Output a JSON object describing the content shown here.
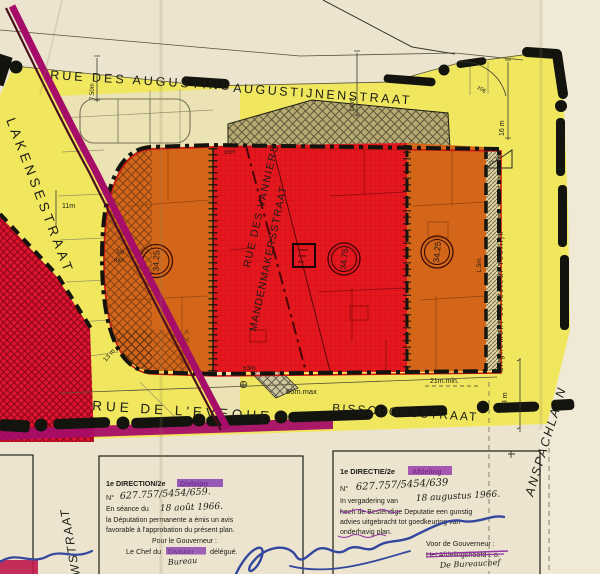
{
  "map": {
    "streets": {
      "rue_des_augustins": "RUE DES AUGUSTINS",
      "augustijnenstraat": "AUGUSTIJNENSTRAAT",
      "lakensestraat": "LAKENSESTRAAT",
      "rue_des_vanniers": "RUE DES VANNIERS",
      "mandenmakersstraat": "MANDENMAKERSSTRAAT",
      "rue_de_l_eveque": "RUE  DE  L'EVEQUE",
      "bisschopsstraat": "BISSCHOPSSTRAAT",
      "anspachlaan": "ANSPACHLAAN",
      "wstraat_partial": "WSTRAAT"
    },
    "measurements": {
      "m750": "7.50m",
      "m14": "14 m",
      "m16": "16 m",
      "angle": "±06",
      "m11": "11m",
      "min3m_a": "3m",
      "min3m_b": "min.",
      "pm3_top": "±3m",
      "pm3_bottom": "±3m",
      "l5m": "L.5m.",
      "max66": "66m.max",
      "min21": "21m.min.",
      "m18": "18 m",
      "m13": "13 m",
      "bench": "18.25"
    },
    "elevations": {
      "left": "34.25",
      "middle": "34.75",
      "right": "34.25"
    },
    "annotations": {
      "collector": "alignement  collecteur  rooilijn"
    }
  },
  "stamps": {
    "fr": {
      "line1a": "1e DIRECTION/2e",
      "line1b": "Division",
      "no_label": "N°",
      "no_value": "627.757/5454/659.",
      "line3a": "En séance du",
      "line3b": "18 août 1966.",
      "line4": "la Députation permanente a émis un avis",
      "line5": "favorable à l'approbation du présent plan.",
      "line6": "Pour le Gouverneur :",
      "line7a": "Le Chef du",
      "line7b": "Division",
      "line7c": "délégué.",
      "line8": "Bureau"
    },
    "nl": {
      "line1a": "1e DIRECTIE/2e",
      "line1b": "Afdeling",
      "no_label": "N°",
      "no_value": "627.757/5454/639",
      "line3a": "In vergadering van",
      "line3b": "18 augustus 1966.",
      "line4": "heeft de Bestendige Deputatie een gunstig",
      "line5": "advies uitgebracht tot goedkeuring van",
      "line6": "onderhavig plan.",
      "line7": "Voor de Gouverneur :",
      "line8": "Het Afdelingshoofd i. o.",
      "line9": "De Bureauchef"
    }
  },
  "colors": {
    "paper": "#ece4cf",
    "yellow": "#f0e75e",
    "pale_parcel": "#ebe3b4",
    "red": "#e5181f",
    "crimson": "#df1430",
    "orange": "#d4661a",
    "magenta": "#a50d68",
    "stamp_purple": "#8136ae",
    "signature_blue": "#33479e",
    "ink_black": "#14140e"
  }
}
